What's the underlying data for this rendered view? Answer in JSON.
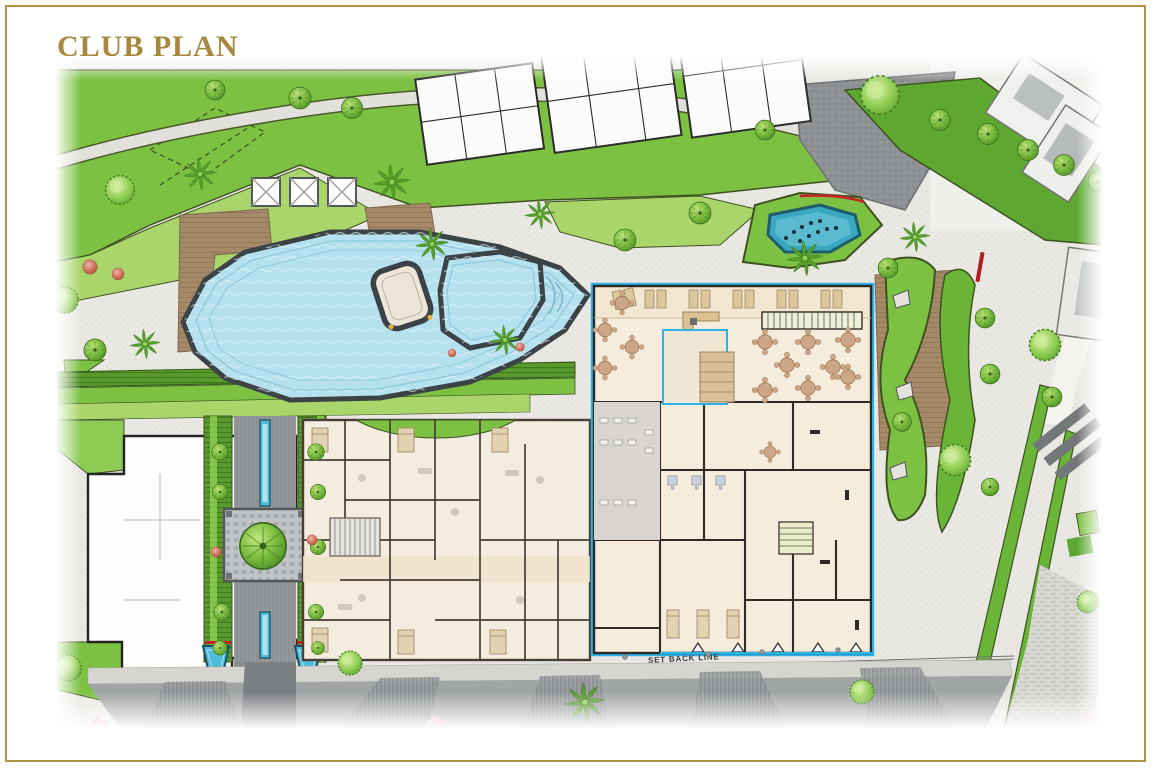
{
  "page": {
    "title": "CLUB PLAN"
  },
  "plan": {
    "labels": {
      "set_back_line": "SET BACK LINE"
    }
  },
  "colors": {
    "frame_gold": "#b29346",
    "title_gold": "#a8873e",
    "lawn_green": "#7cc142",
    "lawn_light": "#a9d56b",
    "hedge_dark": "#47851f",
    "pool_water": "#b5e0ee",
    "pool_outline": "#3c4346",
    "fountain_water": "#39a7c0",
    "accent_cyan": "#2bb3e8",
    "floor_cream": "#f6ecdb",
    "wall_dark": "#2f2a26",
    "deck_wood": "#a58a68",
    "paving_light": "#e9e8e3",
    "paving_dark": "#8b8e90",
    "walkway_gray": "#8f9296",
    "accent_red": "#cc2127"
  }
}
